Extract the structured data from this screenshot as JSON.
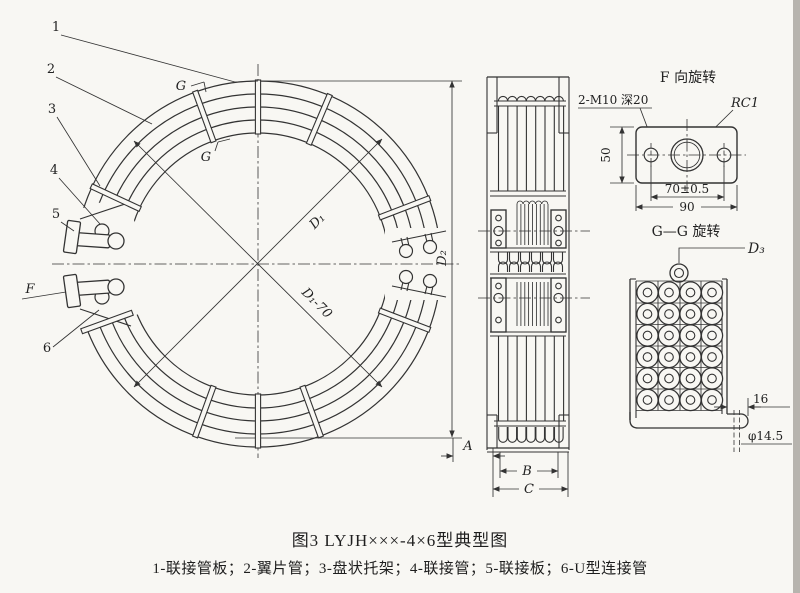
{
  "page": {
    "background": "#f8f7f3",
    "ink": "#333333",
    "scan_edge": "#b7b4ae"
  },
  "caption": {
    "figure_title": "图3 LYJH×××-4×6型典型图",
    "parts_legend": "1-联接管板；2-翼片管；3-盘状托架；4-联接管；5-联接板；6-U型连接管"
  },
  "plan_view": {
    "labels": {
      "p1": "1",
      "p2": "2",
      "p3": "3",
      "p4": "4",
      "p5": "5",
      "p6": "6",
      "view_f": "F",
      "section_g_top": "G",
      "section_g_bottom": "G"
    },
    "dims": {
      "d1": "D₁",
      "d1_minus_70": "D₁-70",
      "d2": "D₂"
    }
  },
  "side_view": {
    "dims": {
      "a": "A",
      "b": "B",
      "c": "C"
    }
  },
  "detail_f": {
    "title": "F 向旋转",
    "thread_note": "2-M10 深20",
    "pipe_thread_note": "RC1",
    "dims": {
      "height": "50",
      "bolt_span": "70±0.5",
      "width": "90"
    }
  },
  "detail_gg": {
    "title": "G—G 旋转",
    "dims": {
      "d3": "D₃",
      "foot_len": "16",
      "hole_dia": "φ14.5"
    }
  }
}
